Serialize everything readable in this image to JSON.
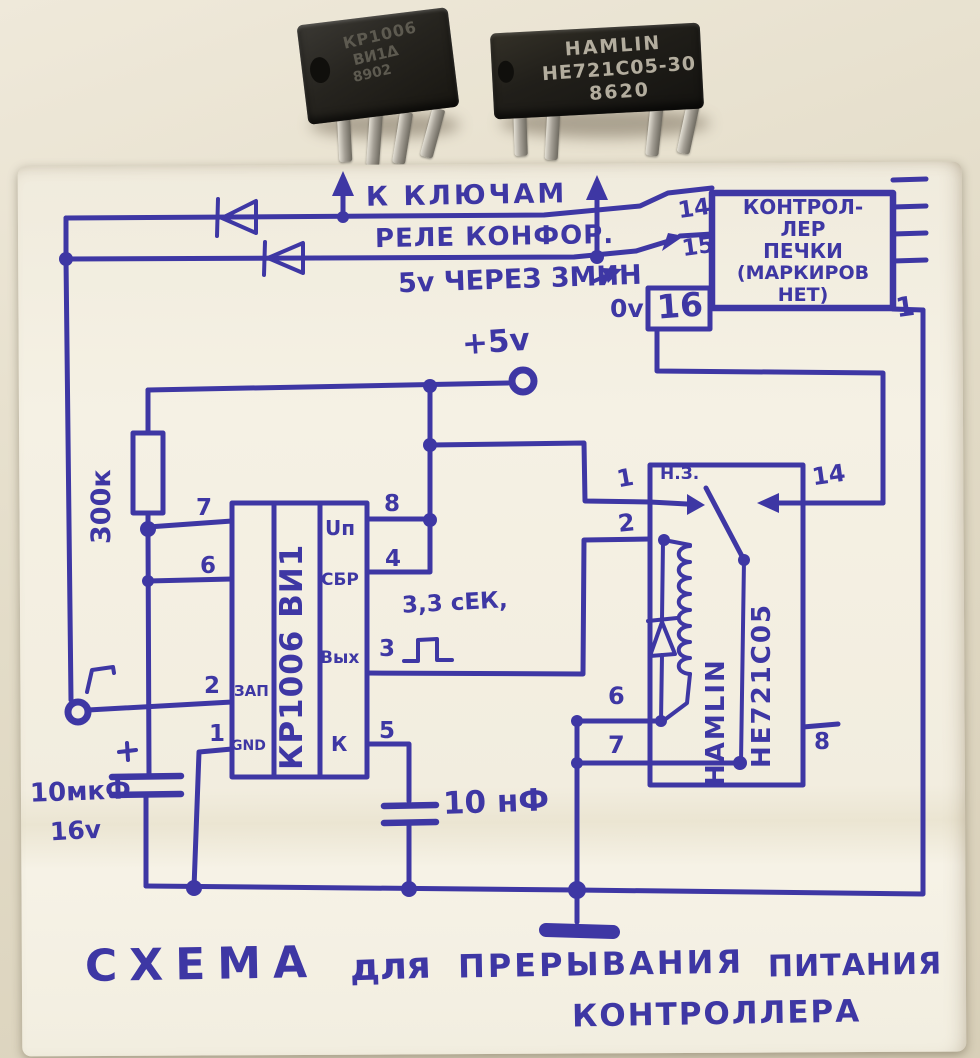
{
  "colors": {
    "ink": "#3e37a4"
  },
  "photo_chips": {
    "left": {
      "line1": "КР1006",
      "line2": "ВИ1Δ",
      "line3": "8902"
    },
    "right": {
      "line1": "HAMLIN",
      "line2": "HE721C05-30",
      "line3": "8620"
    }
  },
  "annotations": {
    "to_keys": "К КЛЮЧАМ",
    "relay_burners": "РЕЛЕ КОНФОР.",
    "delay": "5v ЧЕРЕЗ 3МИН",
    "zero_volts": "0v",
    "plus_five": "+5v",
    "resistor": "300к",
    "pulse": "3,3 сЕК,",
    "cap_polar": "10мкФ",
    "cap_polar_v": "16v",
    "cap_small": "10 нФ"
  },
  "controller": {
    "lines": [
      "КОНТРОЛ-",
      "ЛЕР",
      "ПЕЧКИ",
      "(МАРКИРОВ",
      "НЕТ)"
    ],
    "pin14": "14",
    "pin15": "15",
    "pin16": "16",
    "pin1": "1"
  },
  "timer": {
    "name": "КР1006 ВИ1",
    "pins_left": [
      "7",
      "6",
      "2",
      "1"
    ],
    "pins_right": [
      "8",
      "4",
      "3",
      "5"
    ],
    "zap": "ЗАП",
    "gnd": "GND",
    "up": "Uп",
    "sbr": "СБР",
    "out": "Вых",
    "k": "К"
  },
  "relay": {
    "brand": "HAMLIN",
    "model": "HE721C05",
    "nc": "Н.З.",
    "pin1": "1",
    "pin2": "2",
    "pin6": "6",
    "pin7": "7",
    "pin8": "8",
    "pin14": "14"
  },
  "title": {
    "w1": "СХЕМА",
    "w2": "для",
    "w3": "ПРЕРЫВАНИЯ",
    "w4": "ПИТАНИЯ",
    "line2": "КОНТРОЛЛЕРА"
  }
}
